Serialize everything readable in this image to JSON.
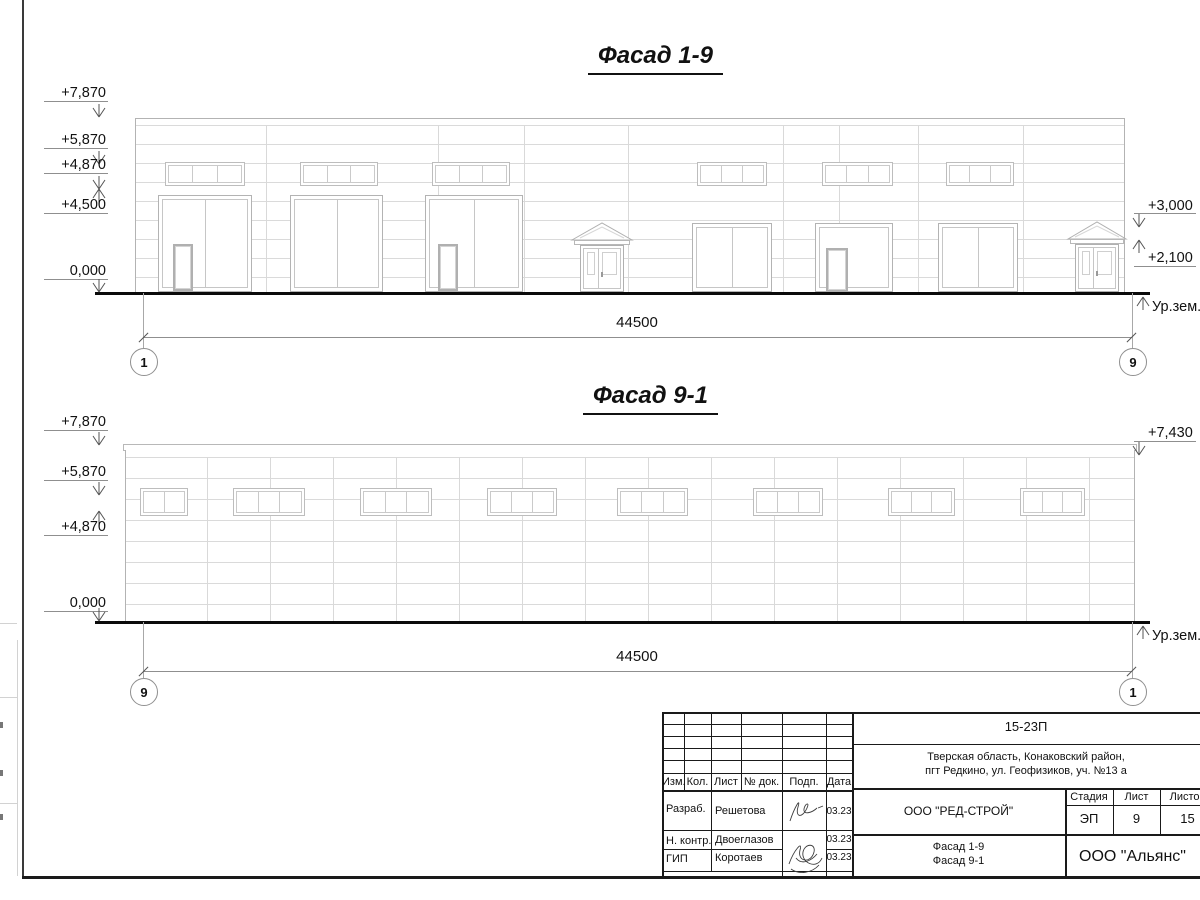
{
  "facades": {
    "top": {
      "title": "Фасад 1-9",
      "dimension": "44500",
      "axis_left": "1",
      "axis_right": "9",
      "ground_label": "Ур.зем.",
      "marks_left": [
        "+7,870",
        "+5,870",
        "+4,870",
        "+4,500",
        "0,000"
      ],
      "marks_right": [
        "+3,000",
        "+2,100"
      ]
    },
    "bottom": {
      "title": "Фасад 9-1",
      "dimension": "44500",
      "axis_left": "9",
      "axis_right": "1",
      "ground_label": "Ур.зем.",
      "marks_left": [
        "+7,870",
        "+5,870",
        "+4,870",
        "0,000"
      ],
      "marks_right": [
        "+7,430"
      ]
    }
  },
  "title_block": {
    "doc_number": "15-23П",
    "address_line1": "Тверская область, Конаковский район,",
    "address_line2": "пгт Редкино, ул. Геофизиков, уч. №13 а",
    "col_headers": [
      "Изм.",
      "Кол.",
      "Лист",
      "№ док.",
      "Подп.",
      "Дата"
    ],
    "rows": [
      {
        "role": "Разраб.",
        "name": "Решетова",
        "date": "03.23"
      },
      {
        "role": "Н. контр.",
        "name": "Двоеглазов",
        "date": "03.23"
      },
      {
        "role": "ГИП",
        "name": "Коротаев",
        "date": "03.23"
      }
    ],
    "designer_org": "ООО \"РЕД-СТРОЙ\"",
    "sheet_name_line1": "Фасад 1-9",
    "sheet_name_line2": "Фасад 9-1",
    "stage_header": "Стадия",
    "sheet_header": "Лист",
    "sheets_header": "Листов",
    "stage": "ЭП",
    "sheet_no": "9",
    "sheets_total": "15",
    "customer_org": "ООО \"Альянс\""
  }
}
